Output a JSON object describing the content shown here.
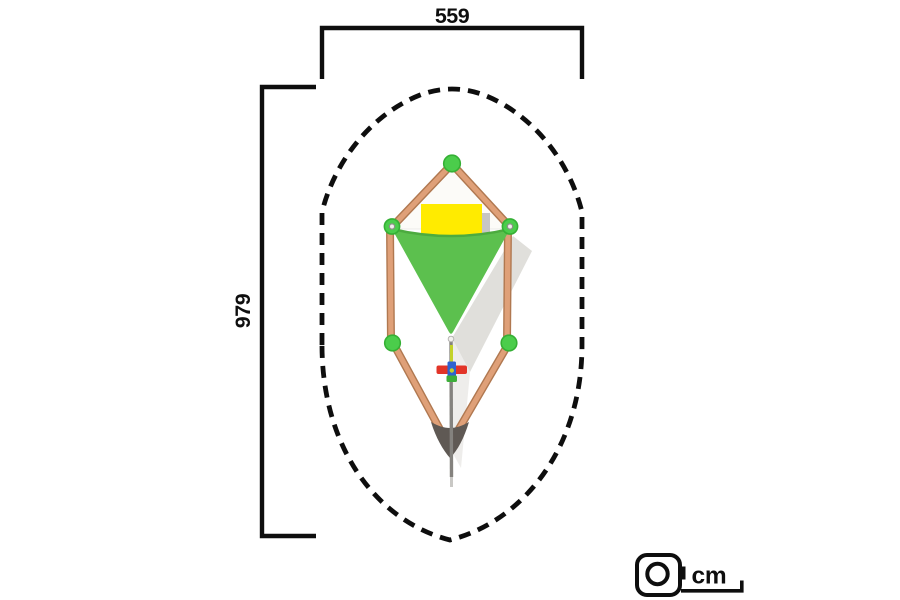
{
  "diagram": {
    "width_label": "559",
    "height_label": "979",
    "unit_label": "cm",
    "colors": {
      "line_black": "#0e0e0e",
      "wood_beam": "#dfa078",
      "wood_beam_edge": "#b07850",
      "post_cap_green": "#4bcd4b",
      "post_cap_rim": "#35b035",
      "shade_sail_green": "#5cc04e",
      "sail_edge_green": "#4cab3f",
      "panel_yellow": "#ffeb00",
      "panel_gray": "#c7c6c4",
      "panel_white": "#fcfbf8",
      "shadow_gray": "#e0dfdb",
      "anchor_dark": "#5f5954",
      "pole_gray": "#84827e",
      "figure_red": "#e23428",
      "figure_blue": "#2f63cf",
      "figure_green": "#3dae3a",
      "figure_yellow": "#c3d229"
    }
  }
}
